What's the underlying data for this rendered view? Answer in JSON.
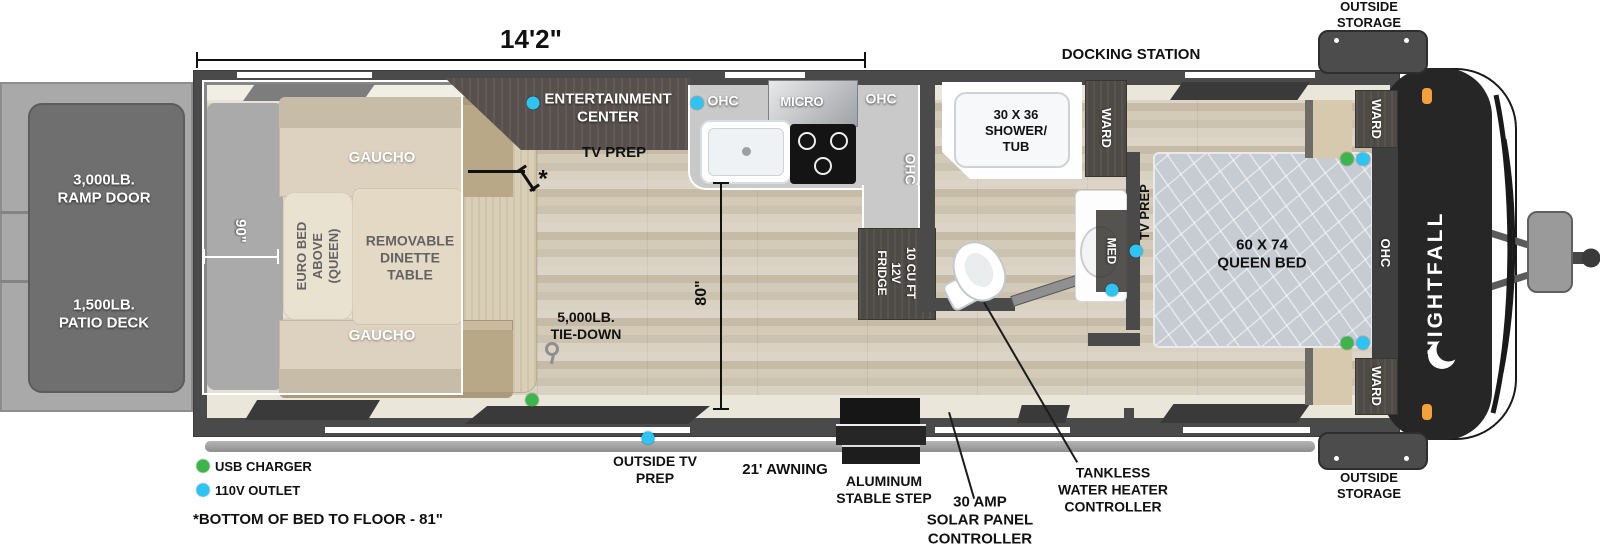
{
  "dims": {
    "length": "14'2\"",
    "width_90": "90\"",
    "height_80": "80\"",
    "asterisk": "*"
  },
  "deck": {
    "ramp_l1": "3,000LB.",
    "ramp_l2": "RAMP DOOR",
    "patio_l1": "1,500LB.",
    "patio_l2": "PATIO DECK"
  },
  "garage": {
    "gaucho": "GAUCHO",
    "euro_l1": "EURO BED",
    "euro_l2": "ABOVE",
    "euro_l3": "(QUEEN)",
    "dinette_l1": "REMOVABLE",
    "dinette_l2": "DINETTE",
    "dinette_l3": "TABLE",
    "tiedown_l1": "5,000LB.",
    "tiedown_l2": "TIE-DOWN"
  },
  "kitchen": {
    "ent_l1": "ENTERTAINMENT",
    "ent_l2": "CENTER",
    "tv_prep": "TV PREP",
    "ohc": "OHC",
    "micro": "MICRO",
    "fridge_l1": "10 CU FT",
    "fridge_l2": "12V",
    "fridge_l3": "FRIDGE"
  },
  "bath": {
    "shower_l1": "30 X 36",
    "shower_l2": "SHOWER/",
    "shower_l3": "TUB",
    "ward": "WARD",
    "med": "MED"
  },
  "bedroom": {
    "bed_l1": "60 X 74",
    "bed_l2": "QUEEN BED",
    "tv_prep": "TV PREP",
    "ohc": "OHC",
    "ward": "WARD"
  },
  "exterior": {
    "docking": "DOCKING STATION",
    "storage_l1": "OUTSIDE",
    "storage_l2": "STORAGE",
    "outside_tv_l1": "OUTSIDE TV",
    "outside_tv_l2": "PREP",
    "awning": "21' AWNING",
    "step_l1": "ALUMINUM",
    "step_l2": "STABLE STEP",
    "solar_l1": "30 AMP",
    "solar_l2": "SOLAR PANEL",
    "solar_l3": "CONTROLLER",
    "tankless_l1": "TANKLESS",
    "tankless_l2": "WATER HEATER",
    "tankless_l3": "CONTROLLER"
  },
  "legend": {
    "usb": "USB CHARGER",
    "outlet": "110V OUTLET",
    "note": "*BOTTOM OF BED TO FLOOR - 81\""
  },
  "brand": {
    "name": "NIGHTFALL"
  },
  "colors": {
    "usb_green": "#3cb54a",
    "outlet_blue": "#2bc4f3",
    "marker_orange": "#f2a13b"
  }
}
